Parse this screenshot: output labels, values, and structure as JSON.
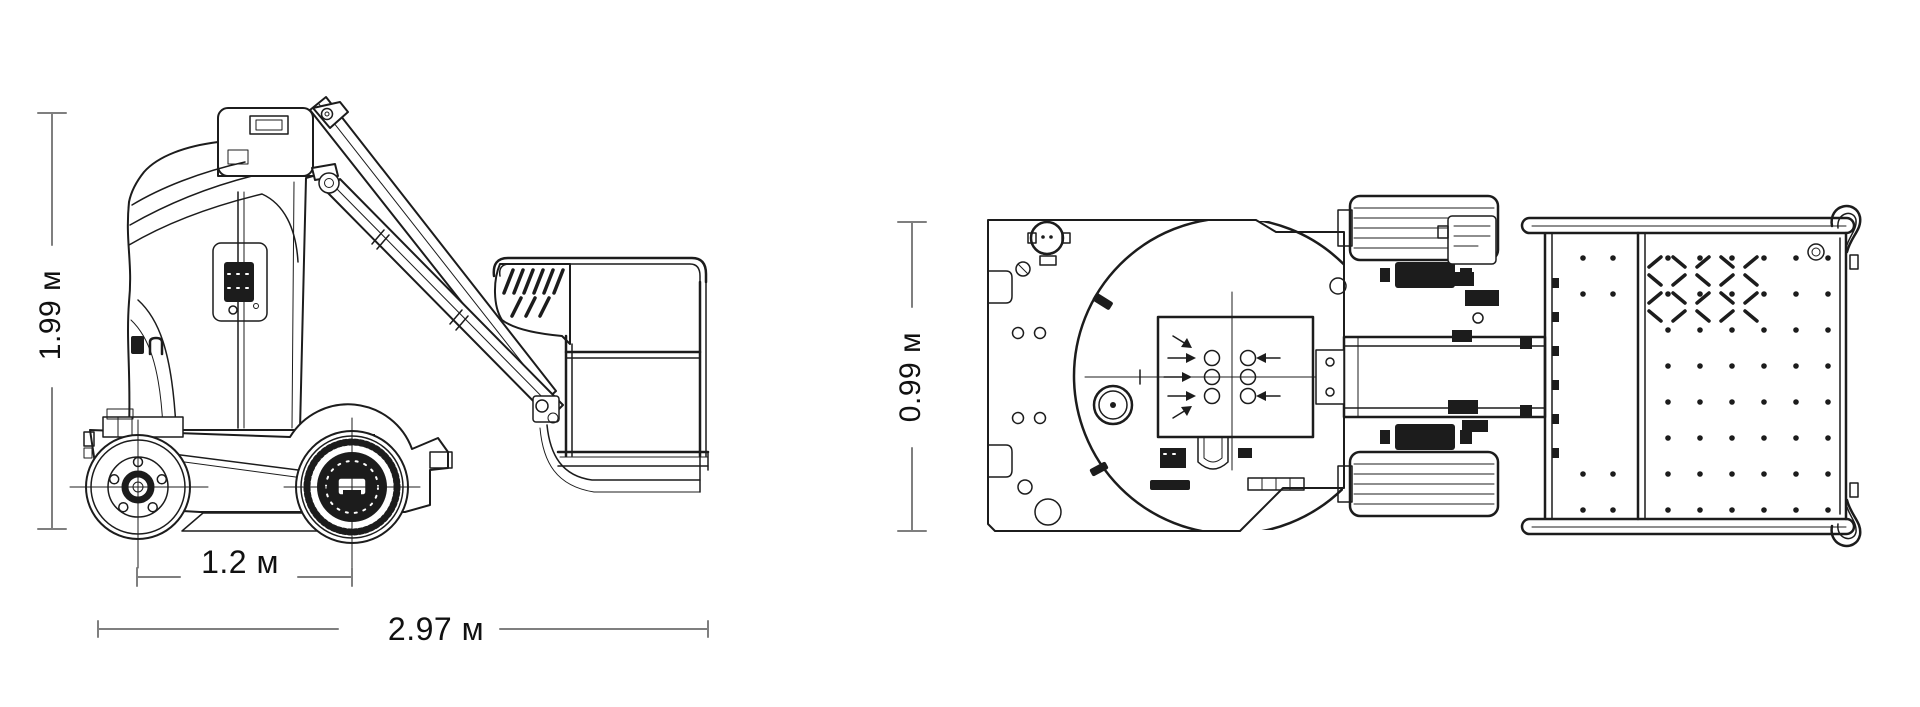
{
  "canvas": {
    "width": 1920,
    "height": 707,
    "background": "#ffffff"
  },
  "drawing": {
    "line_color": "#1c1c1c",
    "dimension_line_color": "#7f7f7f",
    "label_color": "#111111",
    "unit": "м"
  },
  "dimensions": {
    "overall_height": {
      "text": "1.99 м",
      "value": 1.99,
      "unit": "м",
      "orientation": "vertical"
    },
    "wheelbase": {
      "text": "1.2 м",
      "value": 1.2,
      "unit": "м",
      "orientation": "horizontal"
    },
    "overall_length": {
      "text": "2.97 м",
      "value": 2.97,
      "unit": "м",
      "orientation": "horizontal"
    },
    "overall_width": {
      "text": "0.99 м",
      "value": 0.99,
      "unit": "м",
      "orientation": "vertical"
    }
  }
}
